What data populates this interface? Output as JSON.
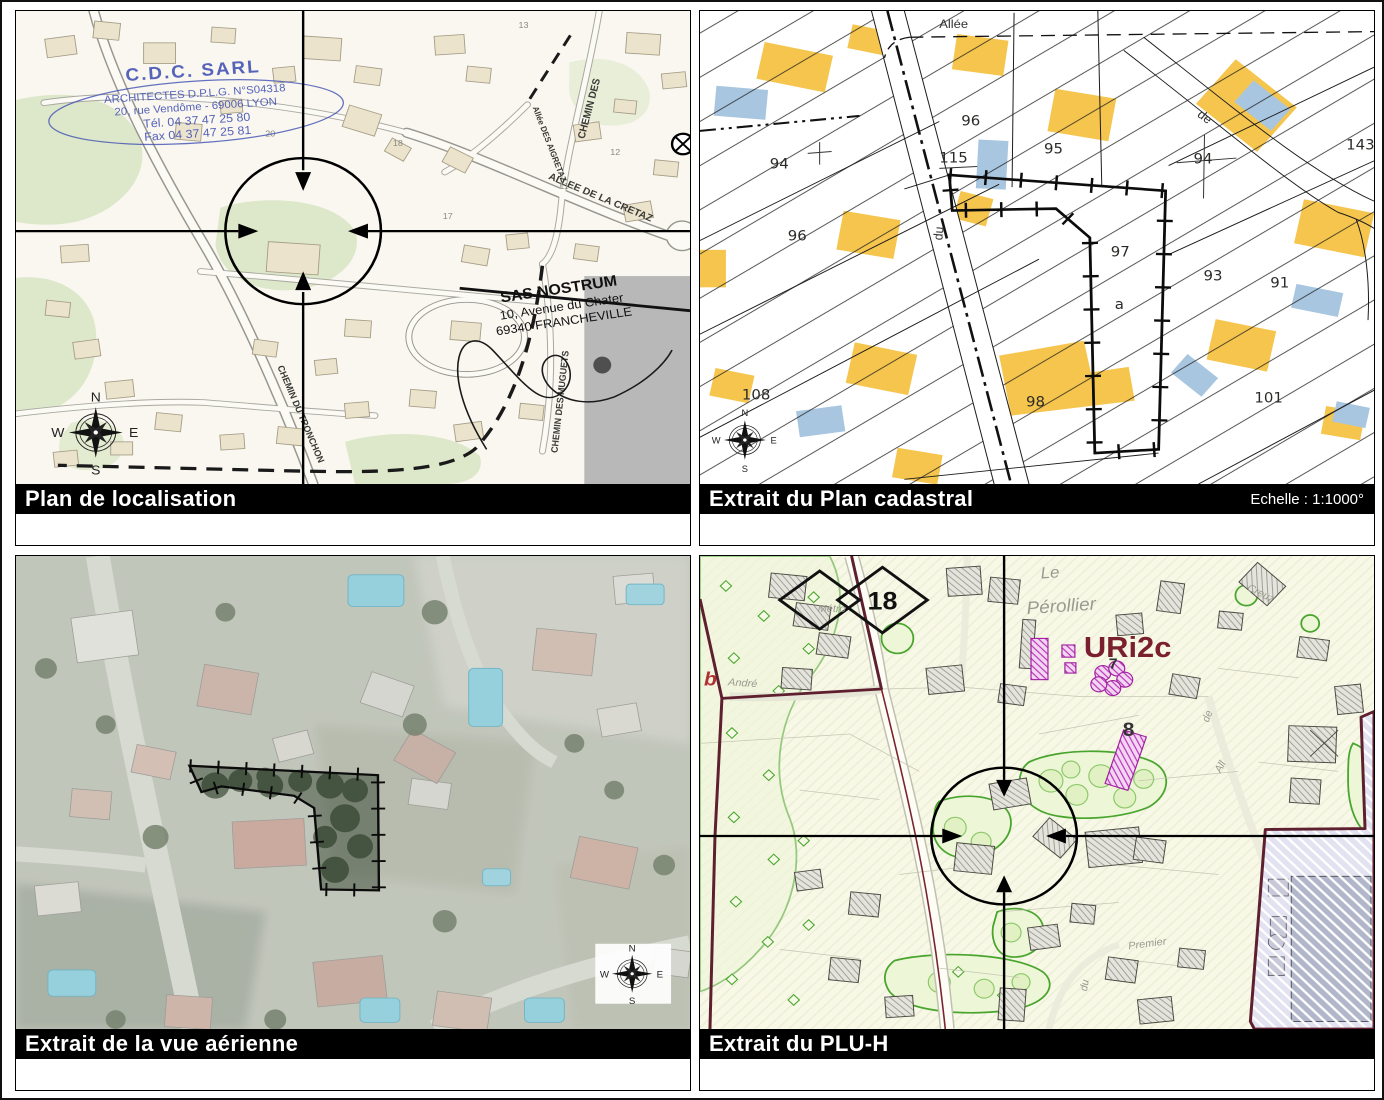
{
  "compass": {
    "n": "N",
    "e": "E",
    "s": "S",
    "w": "W"
  },
  "panels": {
    "localisation": {
      "title": "Plan de localisation",
      "stamp": {
        "line1": "C.D.C. SARL",
        "line2": "ARCHITECTES D.P.L.G. N°S04318",
        "line3": "20, rue Vendôme - 69006 LYON",
        "line4": "Tél. 04 37 47 25 80",
        "line5": "Fax 04 37 47 25 81"
      },
      "address": {
        "line1": "SAS NOSTRUM",
        "line2": "10, Avenue du Chater",
        "line3": "69340 FRANCHEVILLE"
      },
      "streets": {
        "cretaz": "ALLEE DE LA CRETAZ",
        "chemin_des": "CHEMIN DES",
        "aigretaz": "Allée DES AIGRETAZ",
        "tronchon": "CHEMIN DU TRONCHON",
        "muguets": "CHEMIN DES MUGUETS"
      },
      "house_numbers": {
        "n20": "20",
        "n18": "18",
        "n17": "17",
        "n13": "13",
        "n12": "12",
        "n11": "11"
      }
    },
    "cadastral": {
      "title": "Extrait du Plan cadastral",
      "scale": "Echelle : 1:1000°",
      "streets": {
        "allee": "Allée",
        "du": "du",
        "de": "de"
      },
      "parcels": {
        "p94_left": "94",
        "p96_top": "96",
        "p115": "115",
        "p95": "95",
        "p94_right": "94",
        "p143": "143",
        "p96_mid": "96",
        "p97": "97",
        "p97a": "a",
        "p93": "93",
        "p91": "91",
        "p108": "108",
        "p98": "98",
        "p101": "101"
      }
    },
    "aerienne": {
      "title": "Extrait de la vue aérienne"
    },
    "pluh": {
      "title": "Extrait du PLU-H",
      "zone_code": "URi2c",
      "place": {
        "line1": "Le",
        "line2": "Pérollier"
      },
      "sign_18": "18",
      "letter_b": "b",
      "num_7": "7",
      "num_8": "8",
      "streets": {
        "andre": "André",
        "metro": "Métro",
        "premier": "Premier",
        "all": "All",
        "de": "de",
        "du": "du",
        "creuz": "Creuz"
      }
    }
  },
  "colors": {
    "stamp_blue": "#3f4fb2",
    "cadastre_building_yellow": "#f5c54e",
    "cadastre_building_blue": "#a9c6e0",
    "pluh_zone_code_red": "#7a1f2e",
    "pluh_boundary_maroon": "#5e1f2f",
    "pluh_purple": "#c040c0",
    "label_bar_bg": "#000000",
    "label_bar_text": "#ffffff"
  }
}
